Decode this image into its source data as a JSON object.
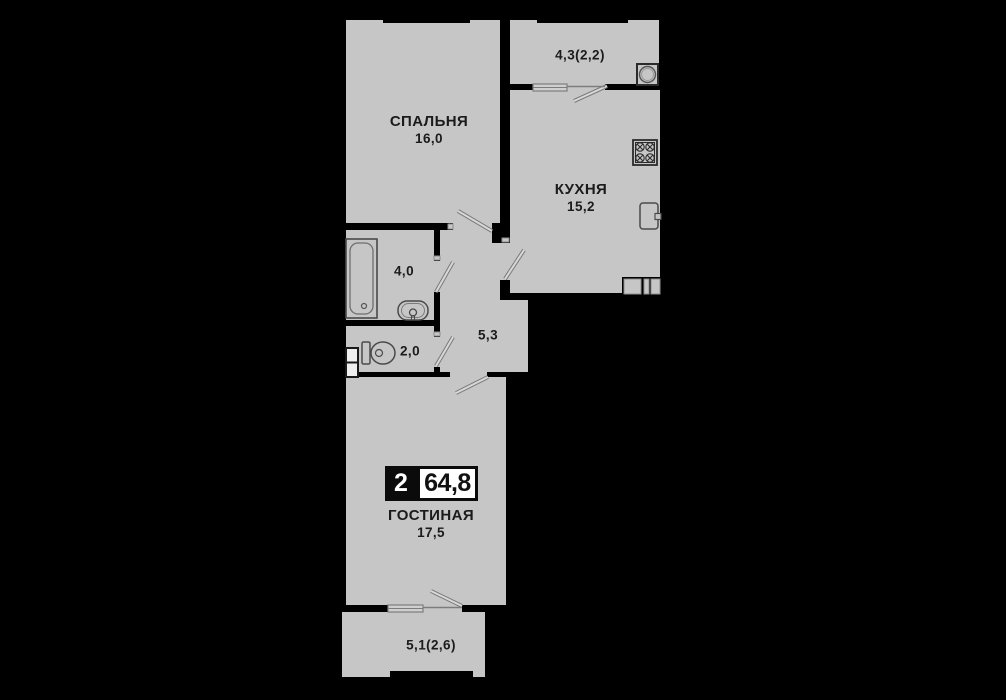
{
  "plan": {
    "type": "apartment-floor-plan",
    "badge": {
      "rooms_count": "2",
      "total_area": "64,8"
    },
    "rooms": [
      {
        "id": "bedroom",
        "name": "СПАЛЬНЯ",
        "area": "16,0"
      },
      {
        "id": "kitchen",
        "name": "КУХНЯ",
        "area": "15,2"
      },
      {
        "id": "living-room",
        "name": "ГОСТИНАЯ",
        "area": "17,5"
      },
      {
        "id": "balcony-top",
        "name": "",
        "area": "4,3(2,2)"
      },
      {
        "id": "bathroom",
        "name": "",
        "area": "4,0"
      },
      {
        "id": "toilet",
        "name": "",
        "area": "2,0"
      },
      {
        "id": "hallway",
        "name": "",
        "area": "5,3"
      },
      {
        "id": "balcony-bottom",
        "name": "",
        "area": "5,1(2,6)"
      }
    ],
    "fixtures": [
      "bathtub-icon",
      "bathroom-sink-icon",
      "toilet-icon",
      "duct-box-icon",
      "washing-machine-icon",
      "stove-icon",
      "kitchen-sink-icon",
      "vent-shaft-icon"
    ],
    "colors": {
      "background": "#000000",
      "floor": "#c6c6c6",
      "wall": "#000000",
      "label_text": "#1b1b1b",
      "badge_block": "#0b0b0b",
      "badge_face": "#ffffff"
    }
  }
}
